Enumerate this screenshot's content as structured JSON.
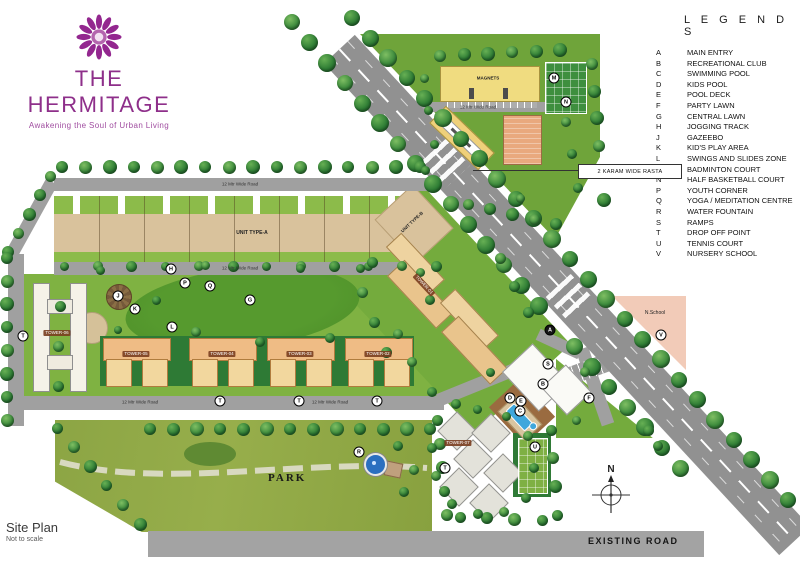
{
  "brand": {
    "name": "THE HERMITAGE",
    "tagline": "Awakening the Soul of Urban Living"
  },
  "legends": {
    "title": "L E G E N D S",
    "items": [
      {
        "key": "A",
        "label": "MAIN ENTRY"
      },
      {
        "key": "B",
        "label": "RECREATIONAL CLUB"
      },
      {
        "key": "C",
        "label": "SWIMMING POOL"
      },
      {
        "key": "D",
        "label": "KIDS POOL"
      },
      {
        "key": "E",
        "label": "POOL DECK"
      },
      {
        "key": "F",
        "label": "PARTY LAWN"
      },
      {
        "key": "G",
        "label": "CENTRAL LAWN"
      },
      {
        "key": "H",
        "label": "JOGGING TRACK"
      },
      {
        "key": "J",
        "label": "GAZEEBO"
      },
      {
        "key": "K",
        "label": "KID'S PLAY AREA"
      },
      {
        "key": "L",
        "label": "SWINGS AND SLIDES ZONE"
      },
      {
        "key": "M",
        "label": "BADMINTON COURT"
      },
      {
        "key": "N",
        "label": "HALF BASKETBALL COURT"
      },
      {
        "key": "P",
        "label": "YOUTH CORNER"
      },
      {
        "key": "Q",
        "label": "YOGA / MEDITATION CENTRE"
      },
      {
        "key": "R",
        "label": "WATER FOUNTAIN"
      },
      {
        "key": "S",
        "label": "RAMPS"
      },
      {
        "key": "T",
        "label": "DROP OFF POINT"
      },
      {
        "key": "U",
        "label": "TENNIS COURT"
      },
      {
        "key": "V",
        "label": "NURSERY SCHOOL"
      }
    ]
  },
  "footer": {
    "title": "Site Plan",
    "subtitle": "Not to scale"
  },
  "map": {
    "compass": "N",
    "labels": {
      "karam_rasta": "2 KARAM WIDE RASTA",
      "existing_road": "EXISTING ROAD",
      "park": "PARK",
      "unit_type_a": "UNIT TYPE-A",
      "unit_type_b": "UNIT TYPE-B",
      "magnets": "MAGNETS",
      "nursery_school": "N.School",
      "road_12m": "12 Mtr Wide Road"
    },
    "tower_labels": [
      "TOWER-06",
      "TOWER-05",
      "TOWER-04",
      "TOWER-03",
      "TOWER-02",
      "TOWER-01",
      "TOWER-07"
    ],
    "marker_letters": [
      "A",
      "B",
      "C",
      "D",
      "E",
      "F",
      "G",
      "H",
      "J",
      "K",
      "L",
      "M",
      "N",
      "P",
      "Q",
      "R",
      "S",
      "T",
      "U",
      "V"
    ]
  },
  "colors": {
    "brand_purple": "#8E2F8A",
    "grass_green": "#7FB242",
    "park_green": "#8CA544",
    "road_gray": "#919191",
    "plot_tan": "#D9C29C",
    "tower_orange": "#EFBC85",
    "pool_blue": "#3FA7DC",
    "building_yellow": "#F0DC80",
    "school_pink": "#F2CBB8"
  }
}
